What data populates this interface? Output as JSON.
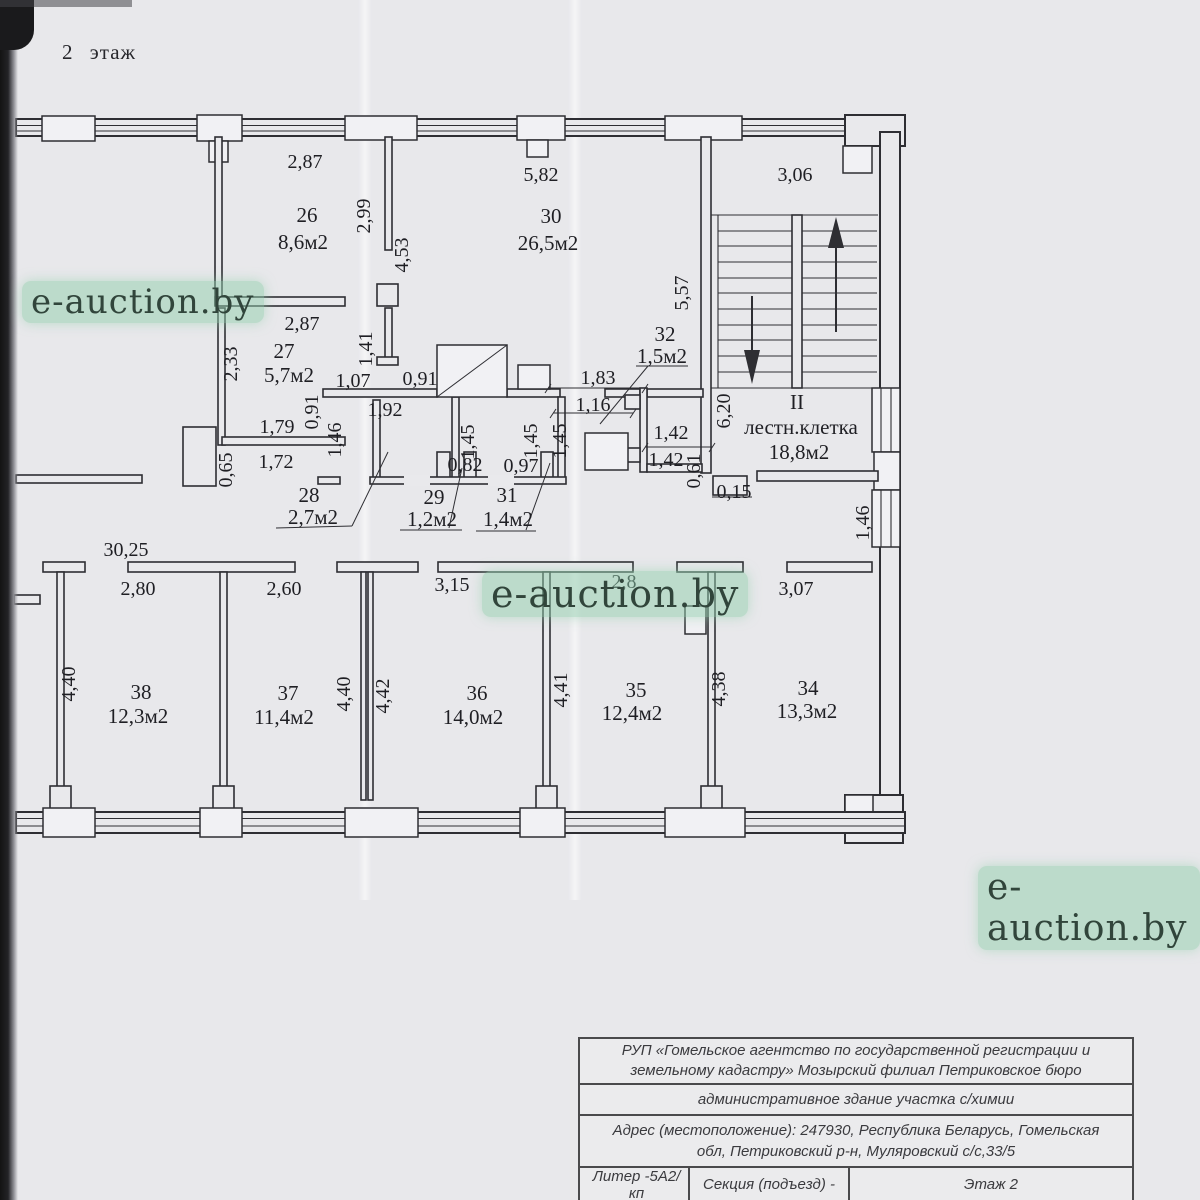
{
  "page": {
    "floor_title": "2 этаж",
    "watermark_text": "e-auction.by"
  },
  "colors": {
    "paper": "#e8e8eb",
    "ink": "#2e2e33",
    "watermark_highlight": "#90cdac",
    "watermark_text": "#31453b",
    "scan_edge": "#131313"
  },
  "rooms": {
    "r26": {
      "number": "26",
      "area": "8,6м2"
    },
    "r27": {
      "number": "27",
      "area": "5,7м2"
    },
    "r28": {
      "number": "28",
      "area": "2,7м2"
    },
    "r29": {
      "number": "29",
      "area": "1,2м2"
    },
    "r30": {
      "number": "30",
      "area": "26,5м2"
    },
    "r31": {
      "number": "31",
      "area": "1,4м2"
    },
    "r32": {
      "number": "32",
      "area": "1,5м2"
    },
    "r34": {
      "number": "34",
      "area": "13,3м2"
    },
    "r35": {
      "number": "35",
      "area": "12,4м2"
    },
    "r36": {
      "number": "36",
      "area": "14,0м2"
    },
    "r37": {
      "number": "37",
      "area": "11,4м2"
    },
    "r38": {
      "number": "38",
      "area": "12,3м2"
    },
    "stairwell": {
      "roman": "II",
      "name": "лестн.клетка",
      "area": "18,8м2"
    }
  },
  "dimensions": {
    "top_room26": "2,87",
    "top_room30": "5,82",
    "top_stairwell": "3,06",
    "v299": "2,99",
    "v453": "4,53",
    "v557": "5,57",
    "room27_width": "2,87",
    "v233": "2,33",
    "v141": "1,41",
    "h107": "1,07",
    "h091": "0,91",
    "h192": "1,92",
    "v091": "0,91",
    "h183": "1,83",
    "h116": "1,16",
    "h179": "1,79",
    "v146a": "1,46",
    "h172": "1,72",
    "v065": "0,65",
    "v145a": "1,45",
    "v145b": "1,45",
    "v145c": "1,45",
    "h082": "0,82",
    "h097": "0,97",
    "h142a": "1,42",
    "h142b": "1,42",
    "v061": "0,61",
    "v620": "6,20",
    "h015": "0,15",
    "v146b": "1,46",
    "corridor_total": "30,25",
    "room38_width": "2,80",
    "room37_width": "2,60",
    "room36_width": "3,15",
    "room35_width": "2,8",
    "room34_width": "3,07",
    "v440a": "4,40",
    "v440b": "4,40",
    "v442": "4,42",
    "v441": "4,41",
    "v438": "4,38"
  },
  "table": {
    "row1_line1": "РУП «Гомельское агентство по государственной регистрации и",
    "row1_line2": "земельному кадастру» Мозырский филиал Петриковское бюро",
    "row2": "административное здание участка с/химии",
    "row3_line1": "Адрес (местоположение): 247930, Республика Беларусь, Гомельская",
    "row3_line2": "обл, Петриковский р-н, Муляровский  с/с,33/5",
    "row4_liter": "Литер -5А2/кп",
    "row4_section": "Секция (подъезд)  -",
    "row4_floor": "Этаж 2"
  }
}
